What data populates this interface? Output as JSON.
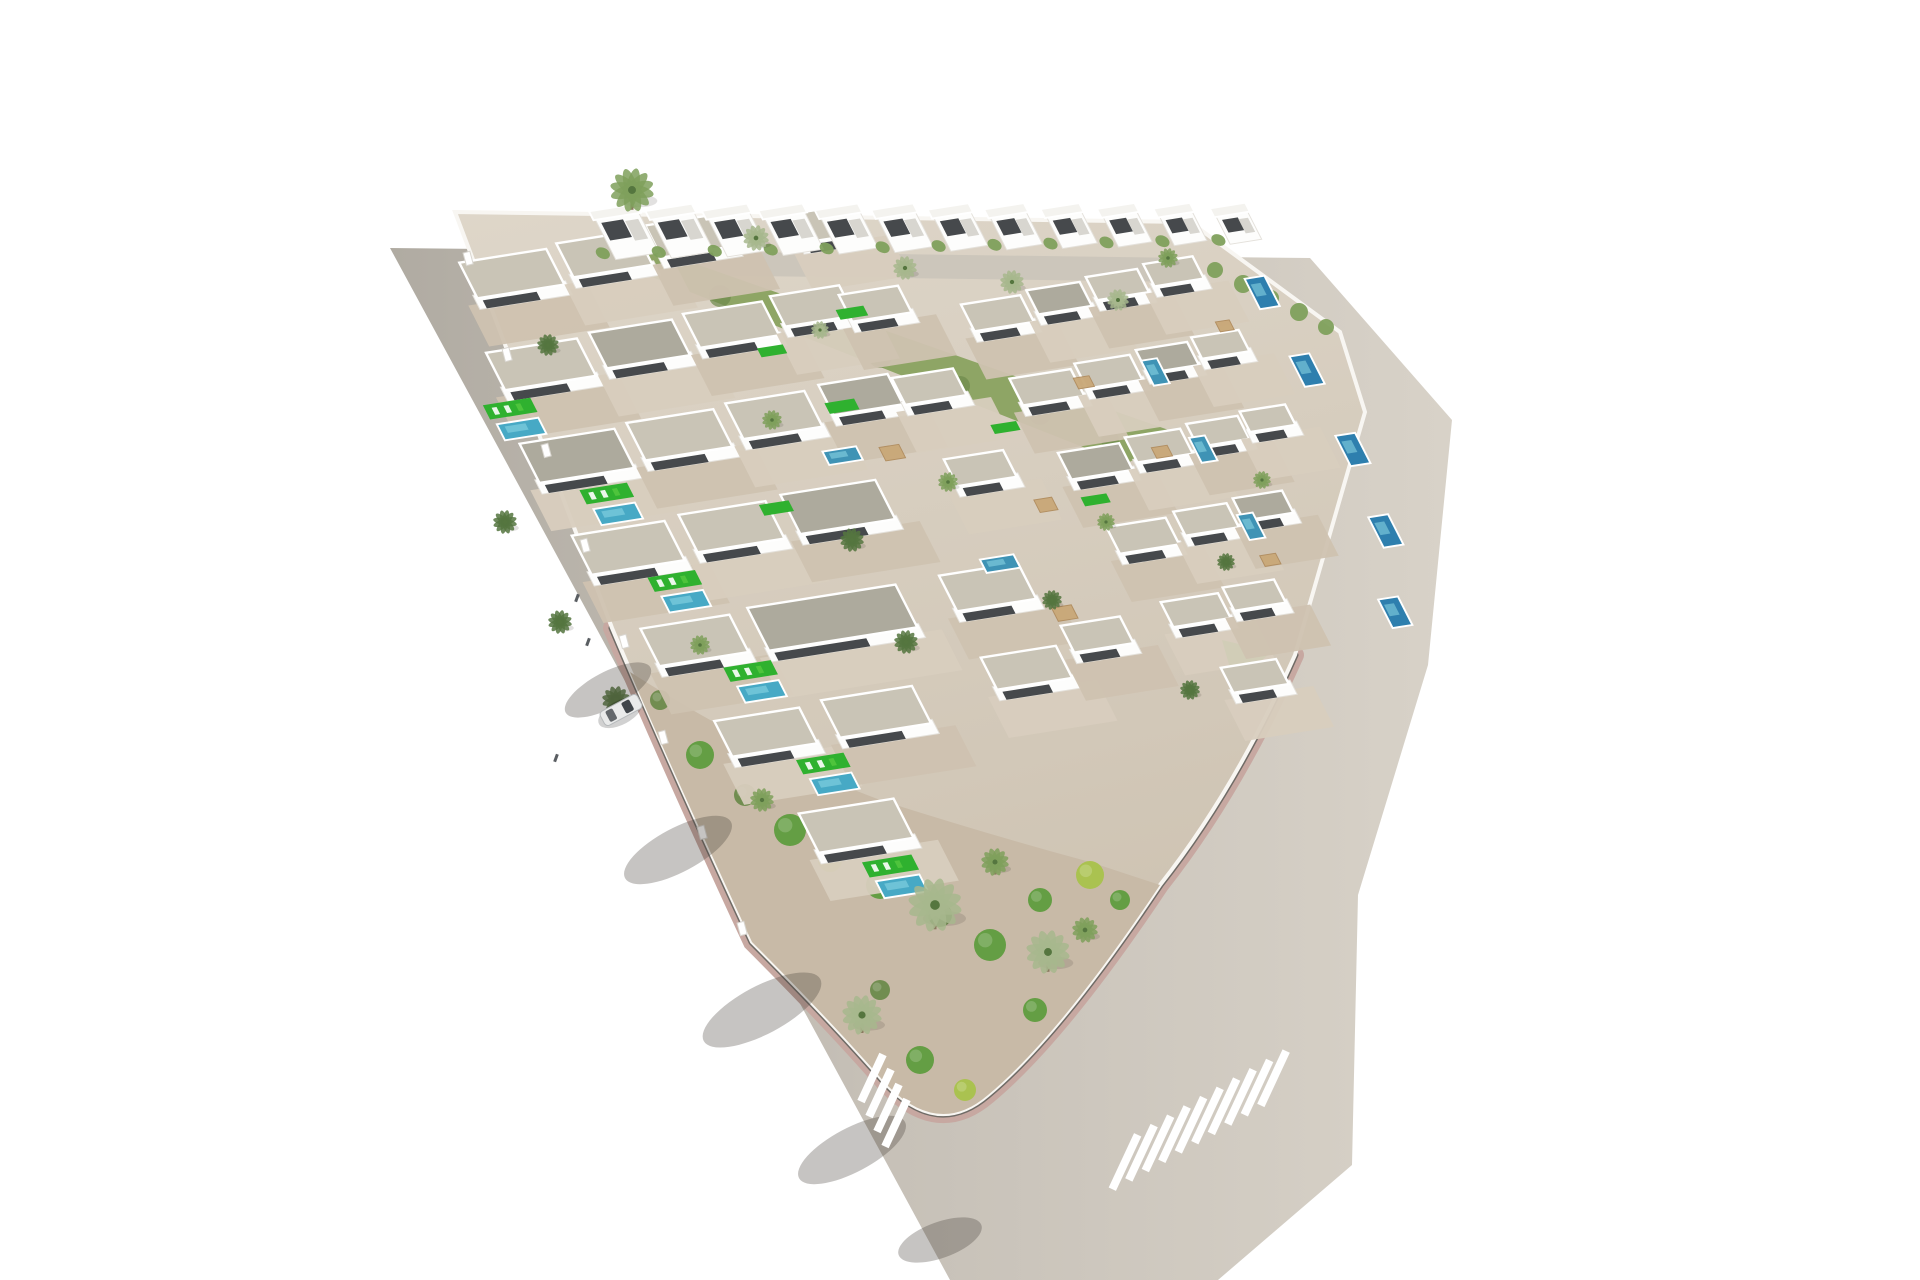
{
  "meta": {
    "type": "3d-aerial-architectural-render",
    "subject": "triangular villa development with pools, palm trees and perimeter roads",
    "caption": ""
  },
  "palette": {
    "background": "#ffffff",
    "road_left": "#b0aba2",
    "road_mid": "#c6c0b7",
    "road_right": "#d8d2c8",
    "plot_top": "#ded6c9",
    "plot_bottom": "#cdc2b1",
    "sidewalk": "#f8f6f2",
    "curb_pink": "#c7a8a1",
    "curb_dark": "#6f6b66",
    "terrace": "#d8cebe",
    "terrace2": "#cfc2b0",
    "building_white": "#fdfdfc",
    "building_edge": "#e4e1db",
    "building_dark": "#363a3d",
    "roof_light": "#c9c4b6",
    "roof_dark": "#adaa9d",
    "roof_cube": "#f4f3ef",
    "lawn": "#2fb12f",
    "lawn_light": "#4ec43c",
    "pool": "#47a9c5",
    "pool_mid": "#3f93b5",
    "pool_deep": "#2e7fae",
    "pool_glint": "#8ed8e6",
    "scrub": "#8ea565",
    "scrub_dark": "#6d8a4b",
    "gravel_garden": "#c8baa7",
    "bush": "#5f9c3e",
    "bush_yellow": "#a9c24b",
    "palm": "#7fa05c",
    "palm_light": "#a7b78d",
    "palm_dark": "#55763f",
    "trunk": "#8a7a5f",
    "shadow": "rgba(66,60,54,0.30)",
    "car_body": "#e9eaea",
    "car_glass": "#41464b",
    "car_line": "#b6b9bb",
    "person": "#5a5e62",
    "internal_road": "#ccc6bb",
    "stripe_white": "#ffffff"
  },
  "scene": {
    "viewbox": "0 0 1920 1280",
    "dev_matrix": "matrix(0.9877,-0.1564,0.454,0.891,462,268)",
    "road_polygon": "390,248 1310,258 1452,420 1428,665 1358,895 1352,1165 1218,1280 950,1280",
    "plot_path": "M455,212 L1190,222 L1340,332 L1365,412 L1295,655 Q1235,790 1160,885 Q1060,1035 988,1095 Q938,1138 886,1084 Q832,1022 752,942 Q672,770 612,628 Q528,408 455,212 Z",
    "tip_path": "M612,628 Q672,770 752,942 Q832,1022 886,1084 Q938,1138 988,1095 Q1060,1035 1160,885 Q1235,790 1295,655",
    "garden_path": "M630,672 Q760,755 880,800 Q990,835 1090,862 L1160,885 Q1060,1035 988,1095 Q938,1138 886,1084 Q832,1022 752,942 Q672,770 630,672 Z",
    "internal_road_polygon": "600,250 1186,258 1192,282 606,274",
    "scrub_polygon": "614,262 656,250 1180,434 1126,464",
    "green_triangle": "1222,640 1272,652 1234,682",
    "scrub_blobs": [
      [
        640,
        268,
        9
      ],
      [
        720,
        296,
        11
      ],
      [
        800,
        326,
        10
      ],
      [
        880,
        356,
        12
      ],
      [
        960,
        386,
        10
      ],
      [
        1040,
        414,
        11
      ],
      [
        1110,
        440,
        9
      ]
    ],
    "hedge": [
      [
        1215,
        270,
        8
      ],
      [
        1243,
        284,
        9
      ],
      [
        1271,
        298,
        8
      ],
      [
        1299,
        312,
        9
      ],
      [
        1326,
        327,
        8
      ]
    ],
    "villas": [
      [
        0,
        -6,
        88,
        40,
        "L"
      ],
      [
        100,
        -10,
        80,
        38,
        "L"
      ],
      [
        192,
        -14,
        74,
        36,
        "L"
      ],
      [
        330,
        -2,
        64,
        32,
        "L"
      ],
      [
        -18,
        92,
        92,
        42,
        "L"
      ],
      [
        88,
        88,
        84,
        40,
        "D"
      ],
      [
        185,
        84,
        80,
        38,
        "L"
      ],
      [
        275,
        80,
        70,
        34,
        "L"
      ],
      [
        340,
        90,
        60,
        30,
        "L"
      ],
      [
        -30,
        192,
        96,
        44,
        "D"
      ],
      [
        80,
        188,
        88,
        42,
        "L"
      ],
      [
        182,
        184,
        80,
        40,
        "L"
      ],
      [
        278,
        180,
        70,
        34,
        "D"
      ],
      [
        350,
        185,
        62,
        30,
        "L"
      ],
      [
        -25,
        296,
        94,
        44,
        "L"
      ],
      [
        85,
        292,
        88,
        42,
        "L"
      ],
      [
        190,
        288,
        96,
        44,
        "D"
      ],
      [
        360,
        278,
        60,
        30,
        "L"
      ],
      [
        -5,
        404,
        90,
        42,
        "L"
      ],
      [
        105,
        400,
        150,
        48,
        "D"
      ],
      [
        300,
        398,
        80,
        40,
        "L"
      ],
      [
        20,
        512,
        86,
        40,
        "L"
      ],
      [
        130,
        508,
        92,
        42,
        "L"
      ],
      [
        300,
        490,
        76,
        36,
        "L"
      ],
      [
        390,
        470,
        60,
        30,
        "L"
      ],
      [
        55,
        622,
        96,
        44,
        "L"
      ],
      [
        450,
        120,
        60,
        30,
        "L"
      ],
      [
        518,
        116,
        54,
        27,
        "D"
      ],
      [
        580,
        112,
        52,
        26,
        "L"
      ],
      [
        640,
        108,
        50,
        25,
        "L"
      ],
      [
        460,
        205,
        62,
        30,
        "L"
      ],
      [
        528,
        200,
        56,
        28,
        "L"
      ],
      [
        592,
        196,
        52,
        26,
        "D"
      ],
      [
        650,
        192,
        48,
        24,
        "L"
      ],
      [
        470,
        290,
        62,
        30,
        "D"
      ],
      [
        540,
        285,
        56,
        28,
        "L"
      ],
      [
        604,
        281,
        52,
        26,
        "L"
      ],
      [
        660,
        277,
        46,
        23,
        "L"
      ],
      [
        480,
        375,
        60,
        30,
        "L"
      ],
      [
        550,
        370,
        54,
        27,
        "L"
      ],
      [
        612,
        366,
        50,
        25,
        "D"
      ],
      [
        495,
        462,
        58,
        28,
        "L"
      ],
      [
        560,
        457,
        52,
        26,
        "L"
      ],
      [
        520,
        540,
        56,
        28,
        "L"
      ]
    ],
    "pools": [
      [
        -42,
        168,
        42,
        18,
        "pool"
      ],
      [
        8,
        272,
        42,
        18,
        "pool"
      ],
      [
        30,
        374,
        42,
        18,
        "pool"
      ],
      [
        58,
        480,
        42,
        18,
        "pool"
      ],
      [
        82,
        588,
        42,
        18,
        "pool"
      ],
      [
        95,
        705,
        44,
        19,
        "pool"
      ],
      [
        250,
        250,
        34,
        15,
        "pool_mid"
      ],
      [
        346,
        388,
        34,
        15,
        "pool_mid"
      ],
      [
        592,
        208,
        16,
        28,
        "pool_mid"
      ],
      [
        600,
        296,
        16,
        28,
        "pool_mid"
      ],
      [
        608,
        384,
        16,
        28,
        "pool_mid"
      ],
      [
        728,
        140,
        20,
        34,
        "pool_deep"
      ],
      [
        733,
        228,
        20,
        34,
        "pool_deep"
      ],
      [
        738,
        318,
        20,
        34,
        "pool_deep"
      ],
      [
        730,
        408,
        20,
        34,
        "pool_deep"
      ],
      [
        700,
        495,
        20,
        32,
        "pool_deep"
      ]
    ],
    "lawns": [
      [
        -46,
        146,
        48,
        16
      ],
      [
        4,
        250,
        48,
        16
      ],
      [
        26,
        352,
        48,
        16
      ],
      [
        54,
        458,
        48,
        16
      ],
      [
        78,
        566,
        48,
        16
      ],
      [
        91,
        683,
        50,
        17
      ],
      [
        165,
        295,
        30,
        12
      ],
      [
        275,
        200,
        30,
        12
      ],
      [
        330,
        105,
        28,
        11
      ],
      [
        420,
        250,
        26,
        10
      ],
      [
        470,
        340,
        26,
        10
      ],
      [
        238,
        132,
        26,
        10
      ]
    ],
    "pergolas": [
      [
        305,
        255,
        20,
        15
      ],
      [
        425,
        335,
        18,
        14
      ],
      [
        520,
        215,
        16,
        12
      ],
      [
        560,
        300,
        16,
        12
      ],
      [
        390,
        450,
        20,
        15
      ],
      [
        610,
        430,
        16,
        12
      ],
      [
        680,
        180,
        14,
        11
      ]
    ],
    "cubes": {
      "n": 12,
      "x0": 148,
      "y0": -34,
      "dx": 53,
      "dy": 9,
      "s0": 44,
      "ds": -1.1
    },
    "bushes": [
      [
        700,
        755,
        14,
        "bush"
      ],
      [
        745,
        795,
        11,
        "scrub_dark"
      ],
      [
        790,
        830,
        16,
        "bush"
      ],
      [
        830,
        860,
        12,
        "bush_yellow"
      ],
      [
        880,
        885,
        14,
        "bush"
      ],
      [
        940,
        915,
        12,
        "scrub_dark"
      ],
      [
        990,
        945,
        16,
        "bush"
      ],
      [
        1040,
        900,
        12,
        "bush"
      ],
      [
        1090,
        875,
        14,
        "bush_yellow"
      ],
      [
        1120,
        900,
        10,
        "bush"
      ],
      [
        920,
        1060,
        14,
        "bush"
      ],
      [
        965,
        1090,
        11,
        "bush_yellow"
      ],
      [
        880,
        990,
        10,
        "scrub_dark"
      ],
      [
        1035,
        1010,
        12,
        "bush"
      ],
      [
        660,
        700,
        10,
        "scrub_dark"
      ]
    ],
    "palms": [
      [
        632,
        190,
        22,
        "palm"
      ],
      [
        756,
        238,
        13,
        "palm_light"
      ],
      [
        905,
        268,
        12,
        "palm_light"
      ],
      [
        1012,
        282,
        12,
        "palm_light"
      ],
      [
        1118,
        300,
        11,
        "palm_light"
      ],
      [
        1168,
        258,
        10,
        "palm"
      ],
      [
        548,
        345,
        11,
        "palm_dark"
      ],
      [
        505,
        522,
        12,
        "palm_dark"
      ],
      [
        560,
        622,
        12,
        "palm_dark"
      ],
      [
        616,
        700,
        14,
        "palm_dark"
      ],
      [
        700,
        645,
        10,
        "palm"
      ],
      [
        852,
        540,
        12,
        "palm_dark"
      ],
      [
        948,
        482,
        10,
        "palm"
      ],
      [
        906,
        642,
        12,
        "palm_dark"
      ],
      [
        1052,
        600,
        10,
        "palm_dark"
      ],
      [
        1106,
        522,
        9,
        "palm"
      ],
      [
        1226,
        562,
        9,
        "palm_dark"
      ],
      [
        1262,
        480,
        9,
        "palm"
      ],
      [
        1190,
        690,
        10,
        "palm_dark"
      ],
      [
        772,
        420,
        10,
        "palm"
      ],
      [
        820,
        330,
        9,
        "palm_light"
      ],
      [
        935,
        905,
        27,
        "palm_light"
      ],
      [
        1048,
        952,
        22,
        "palm_light"
      ],
      [
        862,
        1015,
        20,
        "palm_light"
      ],
      [
        995,
        862,
        14,
        "palm"
      ],
      [
        762,
        800,
        12,
        "palm"
      ],
      [
        1085,
        930,
        13,
        "palm"
      ]
    ],
    "road_shadows": [
      [
        608,
        690,
        18,
        48,
        62
      ],
      [
        678,
        850,
        22,
        60,
        62
      ],
      [
        762,
        1010,
        24,
        66,
        62
      ],
      [
        852,
        1150,
        22,
        60,
        62
      ],
      [
        940,
        1240,
        18,
        44,
        70
      ]
    ],
    "pillars": [
      [
        468,
        258
      ],
      [
        507,
        354
      ],
      [
        546,
        450
      ],
      [
        585,
        545
      ],
      [
        624,
        641
      ],
      [
        663,
        737
      ],
      [
        702,
        832
      ],
      [
        742,
        928
      ]
    ],
    "pedestrians": [
      [
        577,
        598
      ],
      [
        588,
        642
      ],
      [
        556,
        758
      ]
    ],
    "car": {
      "x": 621,
      "y": 710,
      "rot": 62
    },
    "crosswalk_left": {
      "n": 4,
      "x0": 872,
      "y0": 1078,
      "dx": 8,
      "dy": 15,
      "len": 52,
      "w": 8,
      "tilt": 25
    },
    "crosswalk_right": {
      "n": 10,
      "x0": 1125,
      "y0": 1162,
      "dx": 16.5,
      "dy": -9.3,
      "len": 60,
      "w": 8,
      "tilt": 25
    }
  }
}
